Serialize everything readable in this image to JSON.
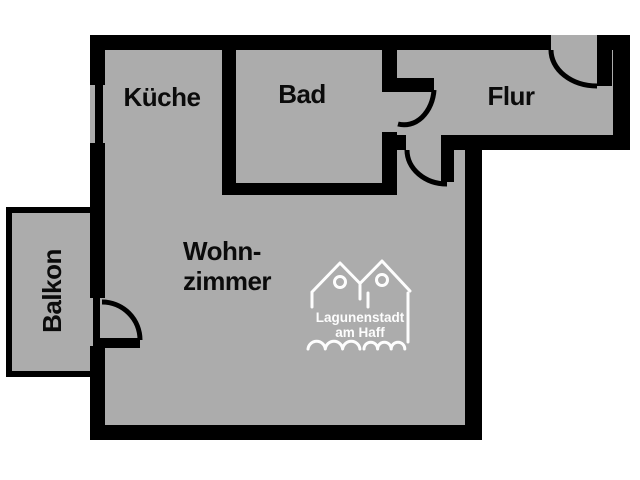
{
  "plan": {
    "type": "apartment-floor-plan",
    "rooms": {
      "kueche": {
        "label": "Küche"
      },
      "bad": {
        "label": "Bad"
      },
      "flur": {
        "label": "Flur"
      },
      "wohnzimmer": {
        "label_line1": "Wohn-",
        "label_line2": "zimmer"
      },
      "balkon": {
        "label": "Balkon"
      }
    }
  },
  "logo": {
    "line1": "Lagunenstadt",
    "line2": "am Haff"
  },
  "colors": {
    "background": "#ffffff",
    "floor": "#acacac",
    "wall": "#000000",
    "label_text": "#0b0b0b",
    "logo": "#fdfdfd"
  }
}
